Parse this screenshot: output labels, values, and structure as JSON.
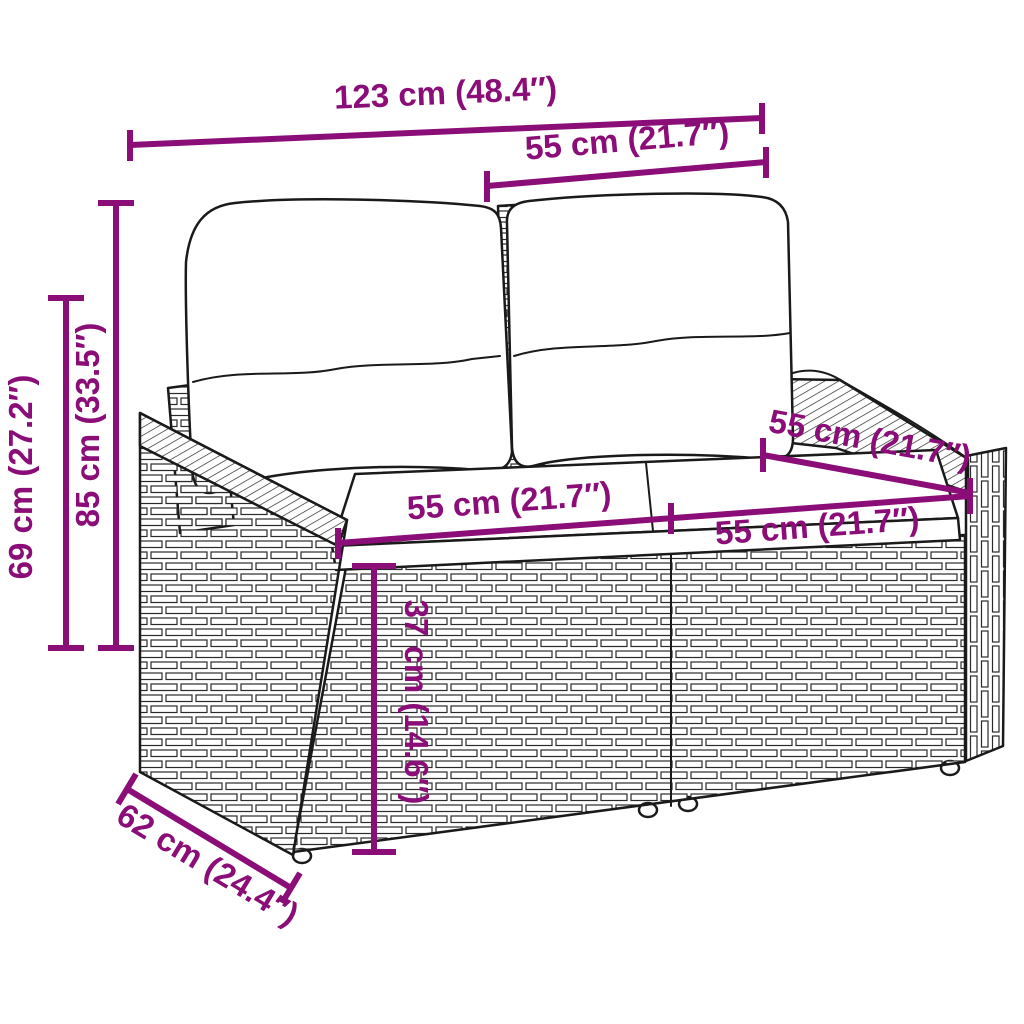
{
  "figure": {
    "subject": "rattan two-seater garden sofa with back and seat cushions, line-art dimension drawing"
  },
  "colors": {
    "dimension": "#8B0D78",
    "line_art": "#1A1A1A",
    "background": "#FFFFFF"
  },
  "dims": {
    "overall_width": {
      "label": "123 cm (48.4″)",
      "cm": 123,
      "inch": 48.4
    },
    "backrest_width": {
      "label": "55 cm (21.7″)",
      "cm": 55,
      "inch": 21.7
    },
    "height_total": {
      "label": "85 cm (33.5″)",
      "cm": 85,
      "inch": 33.5
    },
    "height_armrest": {
      "label": "69 cm (27.2″)",
      "cm": 69,
      "inch": 27.2
    },
    "depth_total": {
      "label": "62 cm (24.4″)",
      "cm": 62,
      "inch": 24.4
    },
    "seat_width_left": {
      "label": "55 cm (21.7″)",
      "cm": 55,
      "inch": 21.7
    },
    "seat_width_right": {
      "label": "55 cm (21.7″)",
      "cm": 55,
      "inch": 21.7
    },
    "seat_depth": {
      "label": "55 cm (21.7″)",
      "cm": 55,
      "inch": 21.7
    },
    "seat_height": {
      "label": "37 cm (14.6″)",
      "cm": 37,
      "inch": 14.6
    }
  }
}
